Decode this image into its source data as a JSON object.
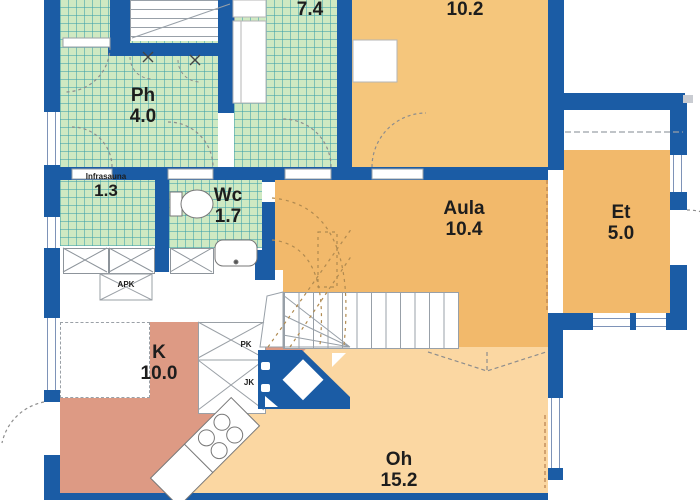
{
  "plan": {
    "type": "floor-plan",
    "rooms": [
      {
        "id": "ph",
        "name": "Ph",
        "area": "4.0"
      },
      {
        "id": "sauna",
        "name": "",
        "area": "7.4"
      },
      {
        "id": "bedroom",
        "name": "",
        "area": "10.2"
      },
      {
        "id": "infrasauna",
        "name": "Infrasauna",
        "area": "1.3"
      },
      {
        "id": "wc",
        "name": "Wc",
        "area": "1.7"
      },
      {
        "id": "aula",
        "name": "Aula",
        "area": "10.4"
      },
      {
        "id": "et",
        "name": "Et",
        "area": "5.0"
      },
      {
        "id": "kitchen",
        "name": "K",
        "area": "10.0"
      },
      {
        "id": "livingroom",
        "name": "Oh",
        "area": "15.2"
      }
    ],
    "appliances": {
      "dishwasher": "APK",
      "freezer": "PK",
      "fridge": "JK"
    },
    "colors": {
      "wall": "#1b5ca5",
      "tile_green": "#cfe9c2",
      "tile_grid": "#5aa0aa",
      "hall_orange": "#f2b96b",
      "bedroom_tan": "#f5c67c",
      "living_orange": "#fbd7a2",
      "kitchen_salmon": "#dd9a84"
    }
  }
}
